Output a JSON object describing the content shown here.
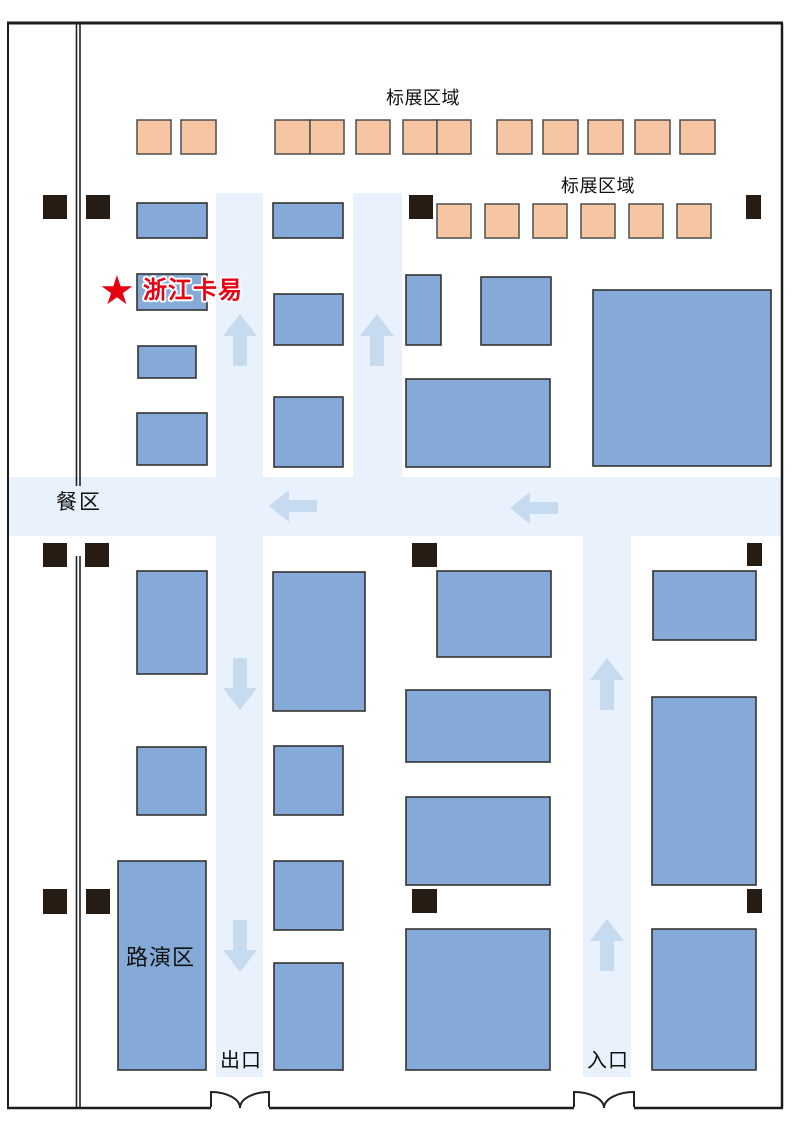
{
  "map": {
    "labels": {
      "standard_zone_top": "标展区域",
      "standard_zone_right": "标展区域",
      "dining_area": "餐区",
      "roadshow_area": "路演区",
      "exit": "出口",
      "entrance": "入口",
      "highlight_booth": "浙江卡易",
      "highlight_star": "★"
    },
    "colors": {
      "booth_blue": "#85aad8",
      "booth_blue_border": "#333333",
      "booth_orange": "#f6c5a2",
      "booth_orange_border": "#4d4d4d",
      "corridor": "#e9f2fc",
      "arrow": "#c6daf0",
      "pillar": "#261c13",
      "wall": "#1c1c1c",
      "highlight_red": "#e60012"
    },
    "floorplan": {
      "outer_wall": {
        "x": 7,
        "y": 23,
        "w": 776,
        "h": 1085
      },
      "inner_wall_xs": [
        76.5,
        80
      ],
      "inner_wall_segments": [
        [
          23,
          486
        ],
        [
          556,
          1107
        ]
      ],
      "doors": [
        {
          "x1": 211,
          "x2": 269,
          "cx": 240,
          "y_top": 1092,
          "y_base": 1107
        },
        {
          "x1": 574,
          "x2": 634,
          "cx": 604,
          "y_top": 1092,
          "y_base": 1107
        }
      ],
      "corridors": [
        {
          "x": 216,
          "y": 193,
          "w": 47,
          "h": 884,
          "name": "aisle-left-vertical"
        },
        {
          "x": 353,
          "y": 193,
          "w": 49,
          "h": 284,
          "name": "aisle-center-vertical"
        },
        {
          "x": 583,
          "y": 477,
          "w": 48,
          "h": 600,
          "name": "aisle-right-vertical"
        },
        {
          "x": 9,
          "y": 477,
          "w": 772,
          "h": 59,
          "name": "aisle-horizontal"
        }
      ],
      "arrows": [
        {
          "dir": "up",
          "x": 240,
          "y": 340
        },
        {
          "dir": "up",
          "x": 377,
          "y": 340
        },
        {
          "dir": "left",
          "x": 293,
          "y": 506
        },
        {
          "dir": "left",
          "x": 534,
          "y": 508
        },
        {
          "dir": "down",
          "x": 240,
          "y": 684
        },
        {
          "dir": "down",
          "x": 240,
          "y": 946
        },
        {
          "dir": "up",
          "x": 607,
          "y": 684
        },
        {
          "dir": "up",
          "x": 607,
          "y": 945
        }
      ],
      "booths_orange": [
        {
          "x": 137,
          "y": 120,
          "w": 34,
          "h": 34
        },
        {
          "x": 181,
          "y": 120,
          "w": 35,
          "h": 34
        },
        {
          "x": 275,
          "y": 120,
          "w": 35,
          "h": 34
        },
        {
          "x": 310,
          "y": 120,
          "w": 34,
          "h": 34
        },
        {
          "x": 356,
          "y": 120,
          "w": 34,
          "h": 34
        },
        {
          "x": 403,
          "y": 120,
          "w": 34,
          "h": 34
        },
        {
          "x": 437,
          "y": 120,
          "w": 34,
          "h": 34
        },
        {
          "x": 497,
          "y": 120,
          "w": 35,
          "h": 34
        },
        {
          "x": 543,
          "y": 120,
          "w": 35,
          "h": 34
        },
        {
          "x": 588,
          "y": 120,
          "w": 35,
          "h": 34
        },
        {
          "x": 635,
          "y": 120,
          "w": 35,
          "h": 34
        },
        {
          "x": 680,
          "y": 120,
          "w": 35,
          "h": 34
        },
        {
          "x": 437,
          "y": 204,
          "w": 34,
          "h": 34
        },
        {
          "x": 485,
          "y": 204,
          "w": 34,
          "h": 34
        },
        {
          "x": 533,
          "y": 204,
          "w": 34,
          "h": 34
        },
        {
          "x": 581,
          "y": 204,
          "w": 34,
          "h": 34
        },
        {
          "x": 629,
          "y": 204,
          "w": 34,
          "h": 34
        },
        {
          "x": 677,
          "y": 204,
          "w": 34,
          "h": 34
        }
      ],
      "booths_blue": [
        {
          "x": 137,
          "y": 203,
          "w": 70,
          "h": 35
        },
        {
          "x": 273,
          "y": 203,
          "w": 70,
          "h": 35
        },
        {
          "x": 137,
          "y": 274,
          "w": 70,
          "h": 36,
          "name": "highlight-booth"
        },
        {
          "x": 138,
          "y": 346,
          "w": 58,
          "h": 32
        },
        {
          "x": 137,
          "y": 413,
          "w": 70,
          "h": 52
        },
        {
          "x": 274,
          "y": 294,
          "w": 69,
          "h": 51
        },
        {
          "x": 274,
          "y": 397,
          "w": 69,
          "h": 70
        },
        {
          "x": 406,
          "y": 275,
          "w": 35,
          "h": 70
        },
        {
          "x": 481,
          "y": 277,
          "w": 70,
          "h": 68
        },
        {
          "x": 406,
          "y": 379,
          "w": 144,
          "h": 88
        },
        {
          "x": 593,
          "y": 290,
          "w": 178,
          "h": 176
        },
        {
          "x": 137,
          "y": 571,
          "w": 70,
          "h": 103
        },
        {
          "x": 273,
          "y": 572,
          "w": 92,
          "h": 139
        },
        {
          "x": 137,
          "y": 747,
          "w": 69,
          "h": 68
        },
        {
          "x": 274,
          "y": 746,
          "w": 69,
          "h": 69
        },
        {
          "x": 437,
          "y": 571,
          "w": 114,
          "h": 86
        },
        {
          "x": 653,
          "y": 571,
          "w": 103,
          "h": 69
        },
        {
          "x": 406,
          "y": 690,
          "w": 144,
          "h": 72
        },
        {
          "x": 652,
          "y": 697,
          "w": 104,
          "h": 188
        },
        {
          "x": 406,
          "y": 797,
          "w": 144,
          "h": 88
        },
        {
          "x": 118,
          "y": 861,
          "w": 88,
          "h": 209,
          "name": "roadshow-area-booth"
        },
        {
          "x": 274,
          "y": 861,
          "w": 69,
          "h": 69
        },
        {
          "x": 274,
          "y": 963,
          "w": 69,
          "h": 107
        },
        {
          "x": 406,
          "y": 929,
          "w": 144,
          "h": 141
        },
        {
          "x": 652,
          "y": 929,
          "w": 104,
          "h": 141
        }
      ],
      "pillars": [
        {
          "x": 43,
          "y": 195,
          "w": 24,
          "h": 24
        },
        {
          "x": 86,
          "y": 195,
          "w": 24,
          "h": 24
        },
        {
          "x": 409,
          "y": 195,
          "w": 24,
          "h": 24
        },
        {
          "x": 746,
          "y": 195,
          "w": 15,
          "h": 24
        },
        {
          "x": 43,
          "y": 543,
          "w": 24,
          "h": 24
        },
        {
          "x": 85,
          "y": 543,
          "w": 24,
          "h": 24
        },
        {
          "x": 412,
          "y": 543,
          "w": 25,
          "h": 24
        },
        {
          "x": 747,
          "y": 543,
          "w": 15,
          "h": 23
        },
        {
          "x": 43,
          "y": 889,
          "w": 24,
          "h": 25
        },
        {
          "x": 86,
          "y": 889,
          "w": 24,
          "h": 25
        },
        {
          "x": 412,
          "y": 889,
          "w": 25,
          "h": 24
        },
        {
          "x": 747,
          "y": 889,
          "w": 15,
          "h": 24
        }
      ]
    }
  }
}
